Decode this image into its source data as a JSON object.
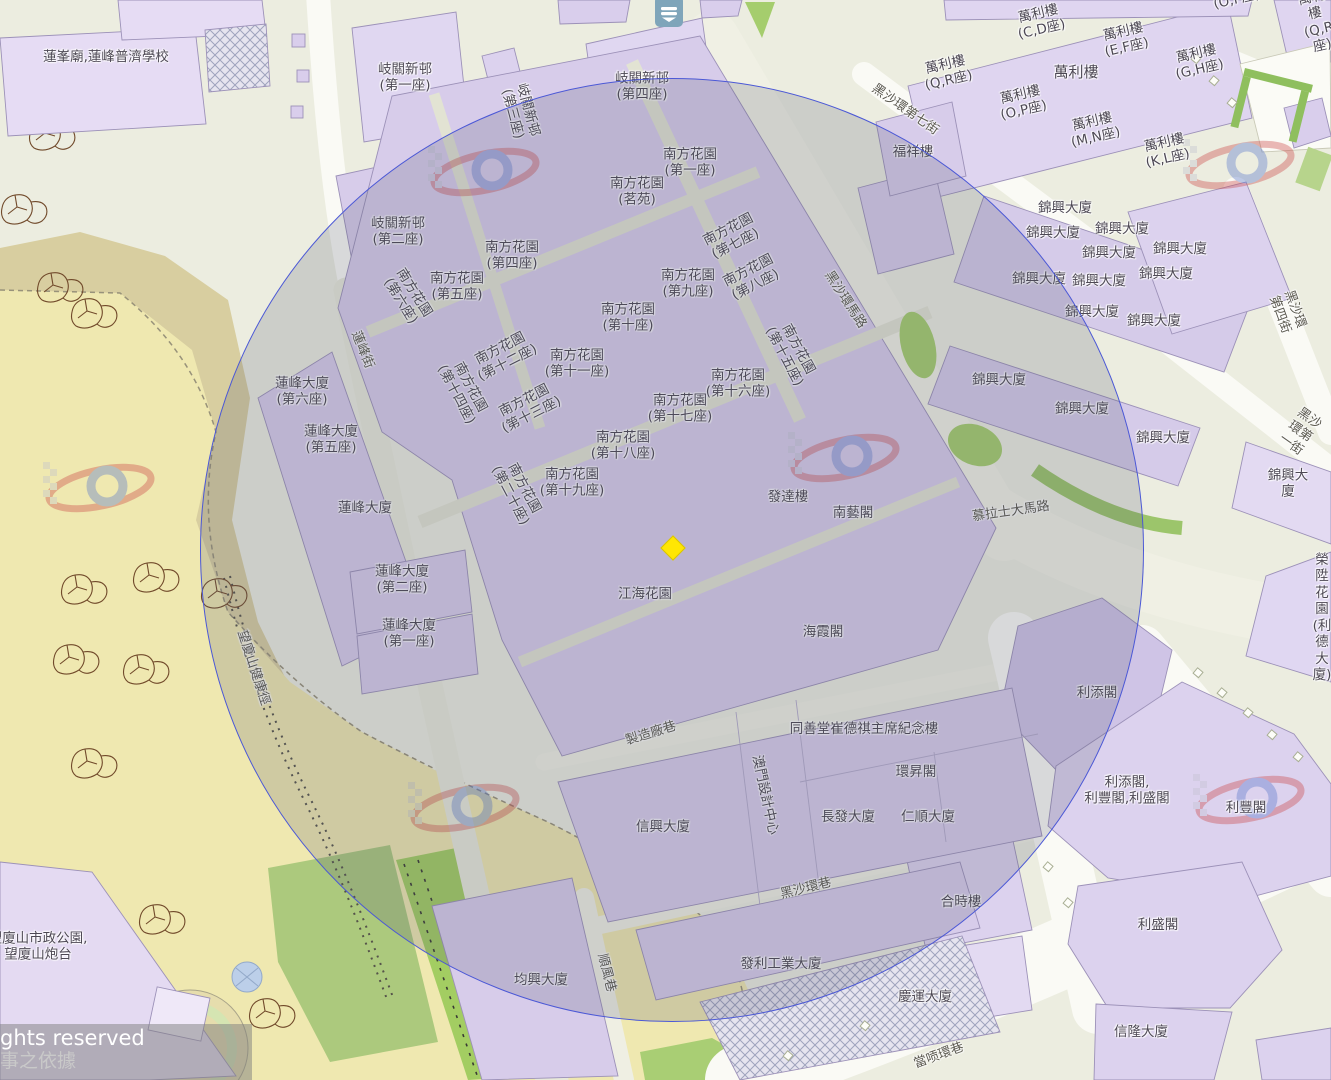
{
  "map": {
    "attribution": {
      "line1": "ghts reserved",
      "line2": "事之依據"
    },
    "controls": {
      "layers_button_icon": "layers-icon"
    },
    "marker": {
      "x": 673,
      "y": 548,
      "color": "#FFE603",
      "shape": "diamond"
    },
    "circle": {
      "cx": 672,
      "cy": 550,
      "r": 472,
      "stroke": "#4b58d6"
    },
    "colors": {
      "land": "#ECEDE0",
      "building": "#D9CEEC",
      "building_light": "#E3DAF2",
      "road_white": "#FAFAF5",
      "road_beige": "#F0F0E4",
      "park_tan": "#D8CEA0",
      "park_yellow": "#EFE8B0",
      "green": "#A5CD6D",
      "overlay": "rgba(82,84,112,0.20)"
    },
    "labels": [
      {
        "id": "lin-fong-temple-school",
        "t": "蓮峯廟,蓮峰普濟學校",
        "x": 106,
        "y": 57
      },
      {
        "id": "kei-kuan-block1",
        "t": "岐關新邨\n(第一座)",
        "x": 405,
        "y": 78
      },
      {
        "id": "kei-kuan-block3",
        "t": "岐關新邨\n(第三座)",
        "x": 520,
        "y": 112,
        "r": 75
      },
      {
        "id": "kei-kuan-block4",
        "t": "岐關新邨\n(第四座)",
        "x": 642,
        "y": 87
      },
      {
        "id": "nam-fong-garden-1",
        "t": "南方花園\n(第一座)",
        "x": 690,
        "y": 163
      },
      {
        "id": "nam-fong-garden-ming-yuen",
        "t": "南方花園\n(茗苑)",
        "x": 637,
        "y": 192
      },
      {
        "id": "kei-kuan-block2",
        "t": "岐關新邨\n(第二座)",
        "x": 398,
        "y": 232
      },
      {
        "id": "nam-fong-garden-4",
        "t": "南方花園\n(第四座)",
        "x": 512,
        "y": 256
      },
      {
        "id": "nam-fong-garden-5",
        "t": "南方花園\n(第五座)",
        "x": 457,
        "y": 287
      },
      {
        "id": "nam-fong-garden-6",
        "t": "南方花園\n(第六座)",
        "x": 407,
        "y": 297,
        "r": 58
      },
      {
        "id": "nam-fong-garden-7",
        "t": "南方花園\n(第七座)",
        "x": 732,
        "y": 237,
        "r": -27
      },
      {
        "id": "nam-fong-garden-8",
        "t": "南方花園\n(第八座)",
        "x": 752,
        "y": 278,
        "r": -27
      },
      {
        "id": "nam-fong-garden-9",
        "t": "南方花園\n(第九座)",
        "x": 688,
        "y": 284
      },
      {
        "id": "nam-fong-garden-10",
        "t": "南方花園\n(第十座)",
        "x": 628,
        "y": 318
      },
      {
        "id": "nam-fong-garden-11",
        "t": "南方花園\n(第十一座)",
        "x": 577,
        "y": 364
      },
      {
        "id": "nam-fong-garden-12",
        "t": "南方花園\n(第十二座)",
        "x": 504,
        "y": 356,
        "r": -27
      },
      {
        "id": "nam-fong-garden-13",
        "t": "南方花園\n(第十三座)",
        "x": 528,
        "y": 408,
        "r": -27
      },
      {
        "id": "nam-fong-garden-14",
        "t": "南方花園\n(第十四座)",
        "x": 463,
        "y": 391,
        "r": 62
      },
      {
        "id": "nam-fong-garden-15",
        "t": "南方花園\n(第十五座)",
        "x": 791,
        "y": 353,
        "r": 62
      },
      {
        "id": "nam-fong-garden-16",
        "t": "南方花園\n(第十六座)",
        "x": 738,
        "y": 384
      },
      {
        "id": "nam-fong-garden-17",
        "t": "南方花園\n(第十七座)",
        "x": 680,
        "y": 409
      },
      {
        "id": "nam-fong-garden-18",
        "t": "南方花園\n(第十八座)",
        "x": 623,
        "y": 446
      },
      {
        "id": "nam-fong-garden-19",
        "t": "南方花園\n(第十九座)",
        "x": 572,
        "y": 483
      },
      {
        "id": "nam-fong-garden-20",
        "t": "南方花園\n(第二十座)",
        "x": 517,
        "y": 492,
        "r": 62
      },
      {
        "id": "lin-fung-building-6",
        "t": "蓮峰大廈\n(第六座)",
        "x": 302,
        "y": 392
      },
      {
        "id": "lin-fung-building-5",
        "t": "蓮峰大廈\n(第五座)",
        "x": 331,
        "y": 440
      },
      {
        "id": "lin-fung-building",
        "t": "蓮峰大廈",
        "x": 365,
        "y": 508
      },
      {
        "id": "lin-fung-building-2",
        "t": "蓮峰大廈\n(第二座)",
        "x": 402,
        "y": 580
      },
      {
        "id": "lin-fung-building-1",
        "t": "蓮峰大廈\n(第一座)",
        "x": 409,
        "y": 634
      },
      {
        "id": "fat-tat-lau",
        "t": "發達樓",
        "x": 788,
        "y": 497
      },
      {
        "id": "nam-ngai-kok",
        "t": "南藝閣",
        "x": 853,
        "y": 513
      },
      {
        "id": "kong-hoi-garden",
        "t": "江海花園",
        "x": 645,
        "y": 594
      },
      {
        "id": "hoi-ha-kok",
        "t": "海霞閣",
        "x": 823,
        "y": 632
      },
      {
        "id": "man-lei-lau-cd",
        "t": "萬利樓\n(C,D座)",
        "x": 1040,
        "y": 22,
        "r": -13
      },
      {
        "id": "man-lei-lau-ef",
        "t": "萬利樓\n(E,F座)",
        "x": 1125,
        "y": 40,
        "r": -13
      },
      {
        "id": "man-lei-lau-gh",
        "t": "萬利樓\n(G,H座)",
        "x": 1198,
        "y": 62,
        "r": -13
      },
      {
        "id": "man-lei-lau-qr",
        "t": "萬利樓\n(Q,R座)",
        "x": 947,
        "y": 73,
        "r": -13
      },
      {
        "id": "man-lei-lau",
        "t": "萬利樓",
        "x": 1076,
        "y": 72,
        "s": 15
      },
      {
        "id": "man-lei-lau-op",
        "t": "萬利樓\n(O,P座)",
        "x": 1022,
        "y": 103,
        "r": -13
      },
      {
        "id": "man-lei-lau-mn",
        "t": "萬利樓\n(M,N座)",
        "x": 1094,
        "y": 130,
        "r": -13
      },
      {
        "id": "man-lei-lau-kl",
        "t": "萬利樓\n(K,L座)",
        "x": 1166,
        "y": 151,
        "r": -13
      },
      {
        "id": "man-lei-lau-qr-2",
        "t": "萬利樓\n(Q,R座)",
        "x": 1317,
        "y": 22,
        "r": -13
      },
      {
        "id": "man-lei-lau-op-2",
        "t": "萬利樓\n(O,P座)",
        "x": 1235,
        "y": -8,
        "r": -13
      },
      {
        "id": "fok-cheong-lau",
        "t": "福祥樓",
        "x": 913,
        "y": 152
      },
      {
        "id": "kam-hing-1",
        "t": "錦興大廈",
        "x": 1065,
        "y": 208
      },
      {
        "id": "kam-hing-2",
        "t": "錦興大廈",
        "x": 1053,
        "y": 233
      },
      {
        "id": "kam-hing-3",
        "t": "錦興大廈",
        "x": 1122,
        "y": 229
      },
      {
        "id": "kam-hing-4",
        "t": "錦興大廈",
        "x": 1109,
        "y": 253
      },
      {
        "id": "kam-hing-5",
        "t": "錦興大廈",
        "x": 1180,
        "y": 249
      },
      {
        "id": "kam-hing-6",
        "t": "錦興大廈",
        "x": 1166,
        "y": 274
      },
      {
        "id": "kam-hing-7",
        "t": "錦興大廈",
        "x": 1039,
        "y": 279
      },
      {
        "id": "kam-hing-8",
        "t": "錦興大廈",
        "x": 1099,
        "y": 281
      },
      {
        "id": "kam-hing-9",
        "t": "錦興大廈",
        "x": 1092,
        "y": 312
      },
      {
        "id": "kam-hing-10",
        "t": "錦興大廈",
        "x": 1154,
        "y": 321
      },
      {
        "id": "kam-hing-11",
        "t": "錦興大廈",
        "x": 999,
        "y": 380
      },
      {
        "id": "kam-hing-12",
        "t": "錦興大廈",
        "x": 1082,
        "y": 409
      },
      {
        "id": "kam-hing-13",
        "t": "錦興大廈",
        "x": 1163,
        "y": 438
      },
      {
        "id": "kam-hing-14",
        "t": "錦興大廈",
        "x": 1288,
        "y": 484
      },
      {
        "id": "wing-seng-garden",
        "t": "榮陞花園\n(利德大廈)",
        "x": 1322,
        "y": 618
      },
      {
        "id": "lei-tim-kok",
        "t": "利添閣",
        "x": 1097,
        "y": 693
      },
      {
        "id": "lei-tim-fong-seng-kok",
        "t": "利添閣,\n利豐閣,利盛閣",
        "x": 1127,
        "y": 791
      },
      {
        "id": "lei-fong-kok",
        "t": "利豐閣",
        "x": 1246,
        "y": 808
      },
      {
        "id": "lei-seng-kok",
        "t": "利盛閣",
        "x": 1158,
        "y": 925
      },
      {
        "id": "son-long-building",
        "t": "信隆大廈",
        "x": 1141,
        "y": 1032
      },
      {
        "id": "hop-si-lau",
        "t": "合時樓",
        "x": 961,
        "y": 902
      },
      {
        "id": "heng-wan-building",
        "t": "慶運大廈",
        "x": 925,
        "y": 997
      },
      {
        "id": "tung-sin-tong-memorial",
        "t": "同善堂崔德祺主席紀念樓",
        "x": 864,
        "y": 729
      },
      {
        "id": "wan-seng-kok",
        "t": "環昇閣",
        "x": 916,
        "y": 772
      },
      {
        "id": "cheong-fat-building",
        "t": "長發大廈",
        "x": 848,
        "y": 817
      },
      {
        "id": "yan-shun-building",
        "t": "仁順大廈",
        "x": 928,
        "y": 817
      },
      {
        "id": "son-hing-building",
        "t": "信興大廈",
        "x": 663,
        "y": 827
      },
      {
        "id": "macau-design-centre",
        "t": "澳門設計中心",
        "x": 765,
        "y": 795,
        "r": 78
      },
      {
        "id": "kuan-hing-building",
        "t": "均興大廈",
        "x": 541,
        "y": 980
      },
      {
        "id": "fat-lei-industrial",
        "t": "發利工業大廈",
        "x": 781,
        "y": 964
      },
      {
        "id": "mong-ha-park",
        "t": "望廈山市政公園,\n望廈山炮台",
        "x": 38,
        "y": 947
      },
      {
        "id": "street-hac-sa-wan-7",
        "t": "黑沙環第七街",
        "x": 905,
        "y": 110,
        "r": 35,
        "c": "s"
      },
      {
        "id": "street-hac-sa-wan-road",
        "t": "黑沙環馬路",
        "x": 845,
        "y": 300,
        "r": 57,
        "c": "s"
      },
      {
        "id": "street-hac-sa-wan-4",
        "t": "黑沙環第四街",
        "x": 1287,
        "y": 312,
        "r": 70,
        "c": "s"
      },
      {
        "id": "street-hac-sa-wan-1",
        "t": "黑沙環第一街",
        "x": 1300,
        "y": 432,
        "r": 35,
        "c": "s"
      },
      {
        "id": "street-venceslau-morais",
        "t": "慕拉士大馬路",
        "x": 1011,
        "y": 512,
        "r": -8,
        "c": "s"
      },
      {
        "id": "street-fabrica",
        "t": "製造廠巷",
        "x": 651,
        "y": 734,
        "r": -17,
        "c": "s"
      },
      {
        "id": "street-hac-sa-wan-lane",
        "t": "黑沙環巷",
        "x": 806,
        "y": 889,
        "r": -14,
        "c": "s"
      },
      {
        "id": "street-son-fong",
        "t": "順風巷",
        "x": 606,
        "y": 973,
        "r": 76,
        "c": "s"
      },
      {
        "id": "street-tong-kong-wan",
        "t": "當唝環巷",
        "x": 939,
        "y": 1056,
        "r": -20,
        "c": "s"
      },
      {
        "id": "street-lin-fung",
        "t": "蓮峰街",
        "x": 362,
        "y": 350,
        "r": 68,
        "c": "s"
      },
      {
        "id": "mong-ha-fitness-trail",
        "t": "望廈山健康徑",
        "x": 253,
        "y": 668,
        "r": 72,
        "c": "s"
      }
    ]
  }
}
